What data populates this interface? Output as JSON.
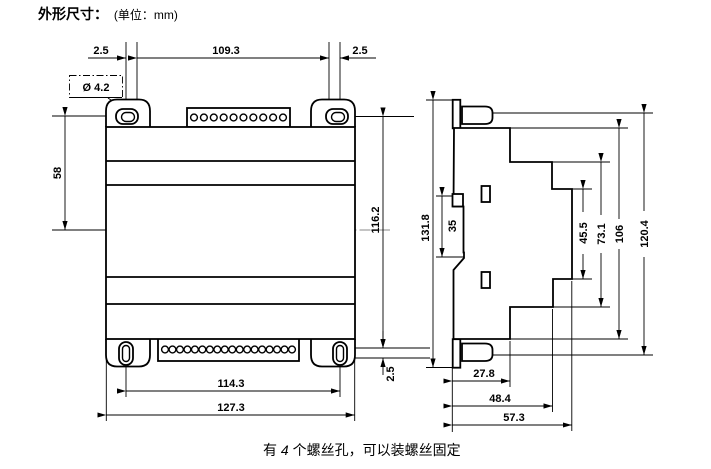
{
  "title": {
    "heading": "外形尺寸：",
    "unit": "(单位：mm)"
  },
  "footnote": {
    "prefix": "有 ",
    "count": "4",
    "suffix": " 个螺丝孔，可以装螺丝固定"
  },
  "front_view": {
    "dims": {
      "top_left_offset": "2.5",
      "top_hole_span": "109.3",
      "top_right_offset": "2.5",
      "screw_hole_dia": "Ø 4.2",
      "upper_height": "58",
      "body_height": "116.2",
      "bottom_ear_offset": "2.5",
      "hole_spacing": "114.3",
      "overall_width": "127.3"
    },
    "top_terminal_hole_count": 10,
    "bottom_terminal_hole_count": 18
  },
  "side_view": {
    "dims": {
      "overall_height": "131.8",
      "din_rail_slot": "35",
      "step_depth_1": "45.5",
      "step_depth_2": "73.1",
      "body_height": "106",
      "overall_with_ears": "120.4",
      "depth_to_step1": "27.8",
      "depth_to_step2": "48.4",
      "overall_depth": "57.3"
    }
  }
}
